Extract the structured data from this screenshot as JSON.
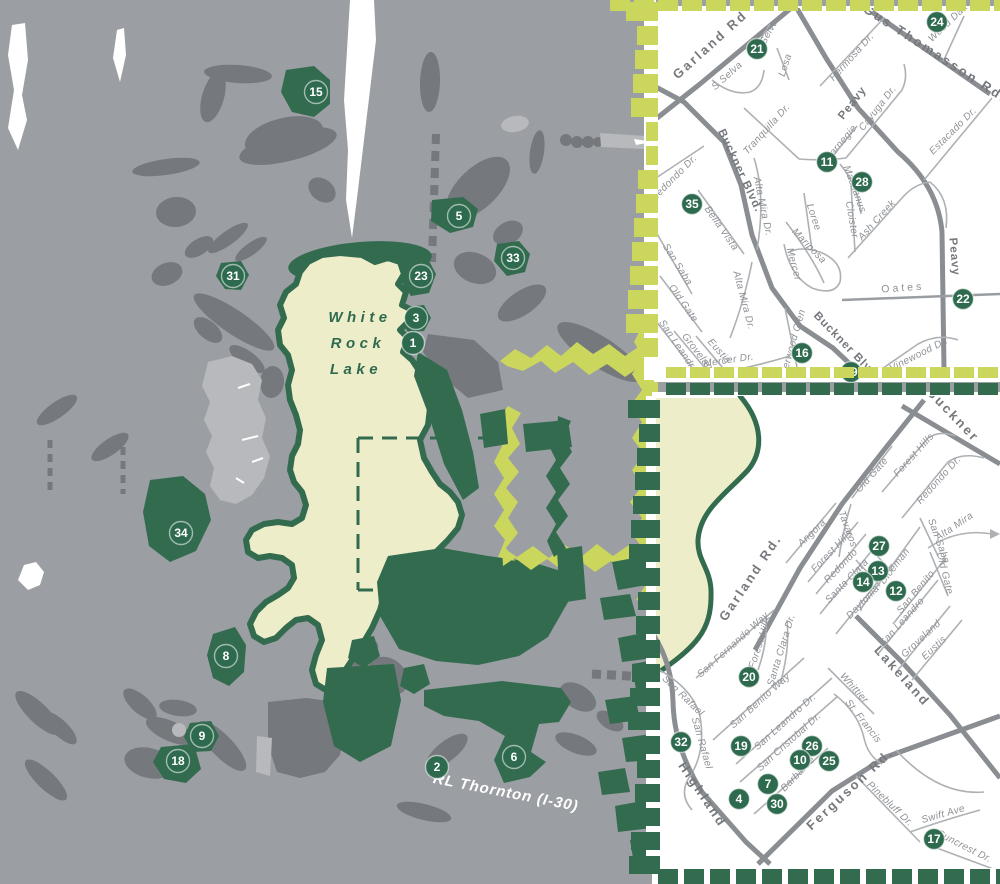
{
  "palette": {
    "background_gray": "#9b9ea2",
    "shape_gray": "#75787c",
    "shape_light_gray": "#b7b9bc",
    "park_green": "#336b4f",
    "marker_green": "#2d6a4e",
    "lake_cream": "#eeedca",
    "inset_accent_yellow": "#cbd65c",
    "road_major_gray": "#8a8d91",
    "road_minor_gray": "#aeb1b4",
    "street_label_gray": "#8e9196",
    "major_label_gray": "#75787c",
    "white": "#ffffff"
  },
  "main_map": {
    "lake_label_lines": [
      "White",
      "Rock",
      "Lake"
    ],
    "highway_label": "RL Thornton (I-30)",
    "markers": [
      {
        "n": "15",
        "x": 316,
        "y": 92
      },
      {
        "n": "5",
        "x": 459,
        "y": 216
      },
      {
        "n": "31",
        "x": 233,
        "y": 276
      },
      {
        "n": "23",
        "x": 421,
        "y": 276
      },
      {
        "n": "33",
        "x": 513,
        "y": 258
      },
      {
        "n": "3",
        "x": 416,
        "y": 318
      },
      {
        "n": "1",
        "x": 413,
        "y": 343
      },
      {
        "n": "34",
        "x": 181,
        "y": 533
      },
      {
        "n": "8",
        "x": 226,
        "y": 656
      },
      {
        "n": "9",
        "x": 202,
        "y": 736
      },
      {
        "n": "18",
        "x": 178,
        "y": 761
      },
      {
        "n": "2",
        "x": 437,
        "y": 767
      },
      {
        "n": "6",
        "x": 514,
        "y": 757
      }
    ]
  },
  "inset_top": {
    "markers": [
      {
        "n": "21",
        "x": 757,
        "y": 49
      },
      {
        "n": "24",
        "x": 937,
        "y": 22
      },
      {
        "n": "11",
        "x": 827,
        "y": 162
      },
      {
        "n": "28",
        "x": 862,
        "y": 182
      },
      {
        "n": "35",
        "x": 692,
        "y": 204
      },
      {
        "n": "22",
        "x": 963,
        "y": 299
      },
      {
        "n": "16",
        "x": 802,
        "y": 353
      },
      {
        "n": "29",
        "x": 851,
        "y": 372
      }
    ],
    "streets": [
      {
        "t": "Garland Rd",
        "x": 713,
        "y": 48,
        "r": -42,
        "c": "M"
      },
      {
        "t": "N Selva",
        "x": 769,
        "y": 38,
        "r": -62,
        "c": "m"
      },
      {
        "t": "Losa",
        "x": 788,
        "y": 66,
        "r": -72,
        "c": "m"
      },
      {
        "t": "S Selva",
        "x": 729,
        "y": 78,
        "r": -42,
        "c": "m"
      },
      {
        "t": "Tranquilla Dr.",
        "x": 769,
        "y": 131,
        "r": -48,
        "c": "m"
      },
      {
        "t": "Hermosa Dr.",
        "x": 854,
        "y": 59,
        "r": -48,
        "c": "m"
      },
      {
        "t": "Gus Thomasson Rd.",
        "x": 933,
        "y": 57,
        "r": 33,
        "c": "M"
      },
      {
        "t": "Wood Dale",
        "x": 951,
        "y": 24,
        "r": -44,
        "c": "m"
      },
      {
        "t": "Peavy",
        "x": 855,
        "y": 105,
        "r": -52,
        "c": "Ms"
      },
      {
        "t": "Carnegie",
        "x": 843,
        "y": 145,
        "r": -50,
        "c": "m"
      },
      {
        "t": "Cayuga Dr.",
        "x": 880,
        "y": 110,
        "r": -52,
        "c": "m"
      },
      {
        "t": "Estacado Dr.",
        "x": 955,
        "y": 133,
        "r": -45,
        "c": "m"
      },
      {
        "t": "Redondo Dr.",
        "x": 676,
        "y": 180,
        "r": -45,
        "c": "m"
      },
      {
        "t": "Buckner Blvd.",
        "x": 737,
        "y": 172,
        "r": 65,
        "c": "Ms"
      },
      {
        "t": "Bella Vista",
        "x": 719,
        "y": 230,
        "r": 55,
        "c": "m"
      },
      {
        "t": "Alta Mira Dr.",
        "x": 760,
        "y": 207,
        "r": 78,
        "c": "m"
      },
      {
        "t": "San Saba",
        "x": 675,
        "y": 266,
        "r": 58,
        "c": "m"
      },
      {
        "t": "Old Gate",
        "x": 681,
        "y": 305,
        "r": 55,
        "c": "m"
      },
      {
        "t": "Alta Mira Dr.",
        "x": 741,
        "y": 301,
        "r": 75,
        "c": "m"
      },
      {
        "t": "San Leandro",
        "x": 676,
        "y": 348,
        "r": 56,
        "c": "m"
      },
      {
        "t": "Groveland",
        "x": 697,
        "y": 356,
        "r": 52,
        "c": "m"
      },
      {
        "t": "Eustis",
        "x": 717,
        "y": 353,
        "r": 48,
        "c": "m"
      },
      {
        "t": "Mercer Dr.",
        "x": 729,
        "y": 363,
        "r": -8,
        "c": "m"
      },
      {
        "t": "Sherwood Glen",
        "x": 795,
        "y": 346,
        "r": -74,
        "c": "m"
      },
      {
        "t": "Loree",
        "x": 811,
        "y": 218,
        "r": 72,
        "c": "m"
      },
      {
        "t": "Mariposa",
        "x": 807,
        "y": 248,
        "r": 46,
        "c": "m"
      },
      {
        "t": "Mercer",
        "x": 791,
        "y": 265,
        "r": 75,
        "c": "m"
      },
      {
        "t": "Machanus",
        "x": 852,
        "y": 190,
        "r": 70,
        "c": "m"
      },
      {
        "t": "Cloister",
        "x": 849,
        "y": 220,
        "r": 80,
        "c": "m"
      },
      {
        "t": "Ash Creek",
        "x": 879,
        "y": 222,
        "r": -48,
        "c": "m"
      },
      {
        "t": "Oates",
        "x": 903,
        "y": 291,
        "r": -4,
        "c": "sp"
      },
      {
        "t": "Peavy",
        "x": 951,
        "y": 257,
        "r": 85,
        "c": "Ms"
      },
      {
        "t": "Buckner Blvd",
        "x": 843,
        "y": 347,
        "r": 46,
        "c": "Ms"
      },
      {
        "t": "Vinewood Dr.",
        "x": 920,
        "y": 357,
        "r": -27,
        "c": "m"
      }
    ]
  },
  "inset_bottom": {
    "markers": [
      {
        "n": "27",
        "x": 879,
        "y": 546
      },
      {
        "n": "13",
        "x": 878,
        "y": 571
      },
      {
        "n": "14",
        "x": 863,
        "y": 582
      },
      {
        "n": "12",
        "x": 896,
        "y": 591
      },
      {
        "n": "20",
        "x": 749,
        "y": 677
      },
      {
        "n": "32",
        "x": 681,
        "y": 742
      },
      {
        "n": "19",
        "x": 741,
        "y": 746
      },
      {
        "n": "26",
        "x": 812,
        "y": 746
      },
      {
        "n": "10",
        "x": 800,
        "y": 760
      },
      {
        "n": "25",
        "x": 829,
        "y": 761
      },
      {
        "n": "7",
        "x": 768,
        "y": 784
      },
      {
        "n": "4",
        "x": 739,
        "y": 799
      },
      {
        "n": "30",
        "x": 777,
        "y": 804
      },
      {
        "n": "17",
        "x": 934,
        "y": 839
      }
    ],
    "streets": [
      {
        "t": "Buckner",
        "x": 950,
        "y": 418,
        "r": 46,
        "c": "M"
      },
      {
        "t": "Garland Rd.",
        "x": 754,
        "y": 580,
        "r": -56,
        "c": "M"
      },
      {
        "t": "Old Gate",
        "x": 874,
        "y": 477,
        "r": -48,
        "c": "m"
      },
      {
        "t": "Forest Hills",
        "x": 916,
        "y": 457,
        "r": -48,
        "c": "m"
      },
      {
        "t": "Redondo Dr.",
        "x": 941,
        "y": 482,
        "r": -48,
        "c": "m"
      },
      {
        "t": "Angora",
        "x": 814,
        "y": 535,
        "r": -44,
        "c": "m"
      },
      {
        "t": "Tavaros",
        "x": 845,
        "y": 530,
        "r": 70,
        "c": "m"
      },
      {
        "t": "Forest Hills",
        "x": 834,
        "y": 553,
        "r": -46,
        "c": "m"
      },
      {
        "t": "Redondo",
        "x": 843,
        "y": 568,
        "r": -46,
        "c": "m"
      },
      {
        "t": "Santa Clara",
        "x": 849,
        "y": 583,
        "r": -46,
        "c": "m"
      },
      {
        "t": "Daytonia",
        "x": 865,
        "y": 604,
        "r": -46,
        "c": "m"
      },
      {
        "t": "Diceman",
        "x": 897,
        "y": 568,
        "r": -52,
        "c": "m"
      },
      {
        "t": "San Benito",
        "x": 918,
        "y": 594,
        "r": -50,
        "c": "m"
      },
      {
        "t": "San Saba",
        "x": 936,
        "y": 542,
        "r": 70,
        "c": "m"
      },
      {
        "t": "Old Gate",
        "x": 942,
        "y": 574,
        "r": 76,
        "c": "m"
      },
      {
        "t": "Alta Mira",
        "x": 956,
        "y": 529,
        "r": -34,
        "c": "m"
      },
      {
        "t": "San Leandro",
        "x": 904,
        "y": 624,
        "r": -48,
        "c": "m"
      },
      {
        "t": "Groveland",
        "x": 923,
        "y": 641,
        "r": -43,
        "c": "m"
      },
      {
        "t": "Eustis",
        "x": 936,
        "y": 650,
        "r": -43,
        "c": "m"
      },
      {
        "t": "Lakeland",
        "x": 899,
        "y": 679,
        "r": 48,
        "c": "M"
      },
      {
        "t": "Whittier",
        "x": 852,
        "y": 690,
        "r": 48,
        "c": "m"
      },
      {
        "t": "St. Francis",
        "x": 861,
        "y": 723,
        "r": 52,
        "c": "m"
      },
      {
        "t": "San Fernando Way",
        "x": 735,
        "y": 647,
        "r": -42,
        "c": "m"
      },
      {
        "t": "Forest Hills",
        "x": 763,
        "y": 643,
        "r": -72,
        "c": "m"
      },
      {
        "t": "Santa Clara Dr.",
        "x": 784,
        "y": 651,
        "r": -73,
        "c": "m"
      },
      {
        "t": "San Benito Way",
        "x": 762,
        "y": 703,
        "r": -42,
        "c": "m"
      },
      {
        "t": "San Leandro Dr.",
        "x": 787,
        "y": 724,
        "r": -42,
        "c": "m"
      },
      {
        "t": "San Cristobal Dr.",
        "x": 791,
        "y": 744,
        "r": -42,
        "c": "m"
      },
      {
        "t": "San Rafael",
        "x": 681,
        "y": 698,
        "r": 44,
        "c": "m"
      },
      {
        "t": "San Rafael",
        "x": 699,
        "y": 744,
        "r": 74,
        "c": "m"
      },
      {
        "t": "Highland",
        "x": 699,
        "y": 797,
        "r": 56,
        "c": "M"
      },
      {
        "t": "Barbaree",
        "x": 800,
        "y": 776,
        "r": -46,
        "c": "m"
      },
      {
        "t": "Ferguson Rd.",
        "x": 853,
        "y": 792,
        "r": -43,
        "c": "M"
      },
      {
        "t": "Pinebluff Dr.",
        "x": 888,
        "y": 806,
        "r": 44,
        "c": "m"
      },
      {
        "t": "Swift Ave",
        "x": 944,
        "y": 817,
        "r": -16,
        "c": "m"
      },
      {
        "t": "Suncrest Dr.",
        "x": 963,
        "y": 849,
        "r": 27,
        "c": "m"
      }
    ]
  }
}
